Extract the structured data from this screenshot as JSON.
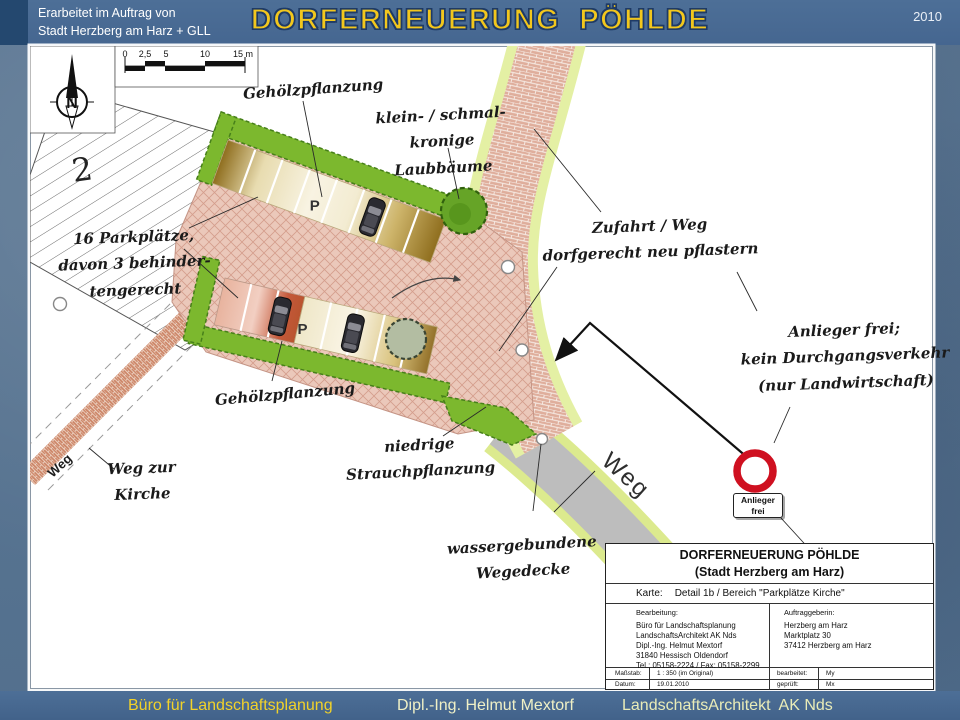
{
  "header": {
    "commission_line1": "Erarbeitet im Auftrag von",
    "commission_line2": "Stadt Herzberg am Harz + GLL",
    "title": "DORFERNEUERUNG  PÖHLDE",
    "year": "2010"
  },
  "footer": {
    "left": "Büro für Landschaftsplanung",
    "center": "Dipl.-Ing. Helmut Mextorf",
    "right": "LandschaftsArchitekt  AK Nds"
  },
  "map": {
    "north_letter": "N",
    "plot_number": "2",
    "scalebar": {
      "labels": [
        "0",
        "2,5",
        "5",
        "10",
        "15 m"
      ]
    },
    "annotations": {
      "gehoelz_top": "Gehölzpflanzung",
      "laubbaeume_line1": "klein- / schmal-",
      "laubbaeume_line2": "kronige Laubbäume",
      "zufahrt_line1": "Zufahrt / Weg",
      "zufahrt_line2": "dorfgerecht neu pflastern",
      "parkplaetze_line1": "16 Parkplätze,",
      "parkplaetze_line2": "davon 3 behinder-",
      "parkplaetze_line3": "tengerecht",
      "gehoelz_bottom": "Gehölzpflanzung",
      "anlieger_line1": "Anlieger frei;",
      "anlieger_line2": "kein Durchgangsverkehr",
      "anlieger_line3": "(nur Landwirtschaft)",
      "strauch_line1": "niedrige",
      "strauch_line2": "Strauchpflanzung",
      "kirche_line1": "Weg zur",
      "kirche_line2": "Kirche",
      "wegedecke_line1": "wassergebundene",
      "wegedecke_line2": "Wegedecke"
    },
    "labels": {
      "weg_road": "Weg",
      "weg_path": "Weg",
      "p_upper": "P",
      "p_lower": "P"
    },
    "sign": {
      "line1": "Anlieger",
      "line2": "frei"
    }
  },
  "titleblock": {
    "title1": "DORFERNEUERUNG PÖHLDE",
    "title2": "(Stadt Herzberg am Harz)",
    "karte_label": "Karte:",
    "karte_value": "Detail 1b / Bereich \"Parkplätze Kirche\"",
    "bearbeitung_label": "Bearbeitung:",
    "bearbeitung_lines": [
      "Büro für Landschaftsplanung",
      "LandschaftsArchitekt  AK Nds",
      "Dipl.-Ing. Helmut Mextorf",
      "31840 Hessisch Oldendorf",
      "Tel.: 05158-2224 / Fax: 05158-2299"
    ],
    "auftraggeberin_label": "Auftraggeberin:",
    "auftraggeberin_lines": [
      "Herzberg am Harz",
      "Marktplatz 30",
      "37412 Herzberg am Harz"
    ],
    "massstab_label": "Maßstab:",
    "massstab_value": "1 : 350 (im Original)",
    "datum_label": "Datum:",
    "datum_value": "19.01.2010",
    "bearbeitet_label": "bearbeitet:",
    "bearbeitet_value": "My",
    "geprueft_label": "geprüft:",
    "geprueft_value": "Mx"
  },
  "colors": {
    "slide_background": "#57718e",
    "band_blue": "#4a6b94",
    "title_yellow": "#f2c71d",
    "footer_yellow": "#f2d229",
    "paving_pink": "#ebc8ba",
    "hedge_green": "#7cb82e",
    "verge_green": "#e4f0a4",
    "road_gray": "#bdbdbd",
    "sign_red": "#cf1020",
    "stall_tan": "#f8f3e2",
    "stall_brown": "#8f6e1e",
    "stall_salmon": "#e8a78f"
  }
}
